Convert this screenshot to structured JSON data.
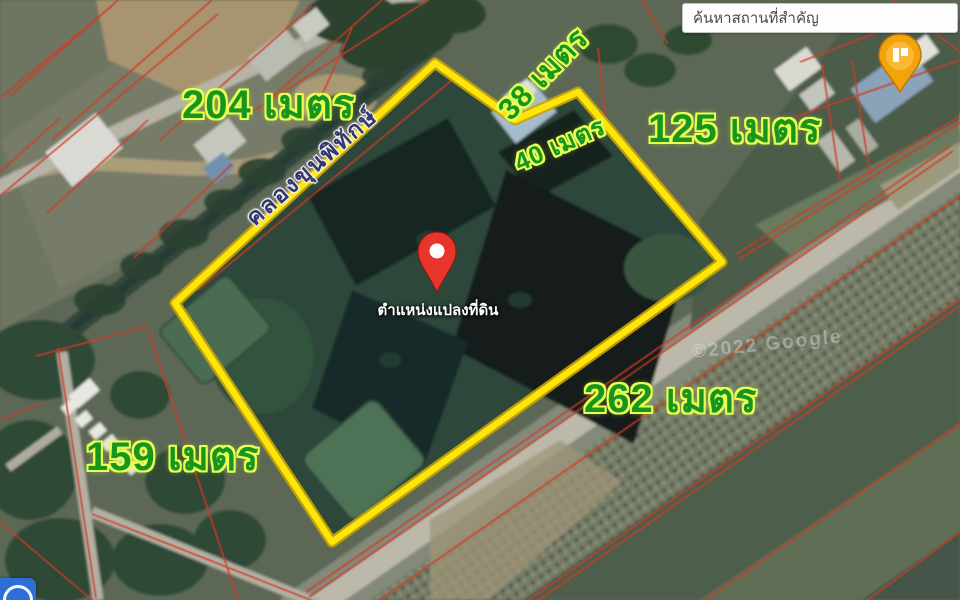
{
  "search": {
    "placeholder": "ค้นหาสถานที่สำคัญ"
  },
  "map": {
    "plot_label": "ตำแหน่งแปลงที่ดิน",
    "canal_name": "คลองขุนพิทักษ์",
    "measurements": {
      "north_west": "204 เมตร",
      "notch_a": "38 เมตร",
      "notch_b": "40 เมตร",
      "north_east": "125 เมตร",
      "south_east": "262 เมตร",
      "south_west": "159 เมตร"
    },
    "watermark": "©2022 Google"
  },
  "icons": {
    "location_pin": "red-location-pin",
    "landmark_pin": "orange-landmark-pin",
    "map_control": "blue-circle-control"
  },
  "colors": {
    "boundary_yellow": "#ffe60a",
    "parcel_red": "#d23a28",
    "label_green": "#18951f",
    "label_glow": "#e9ff54",
    "pin_red": "#e8352b",
    "landmark_orange": "#f3a40a",
    "control_blue": "#2e6ed9"
  }
}
